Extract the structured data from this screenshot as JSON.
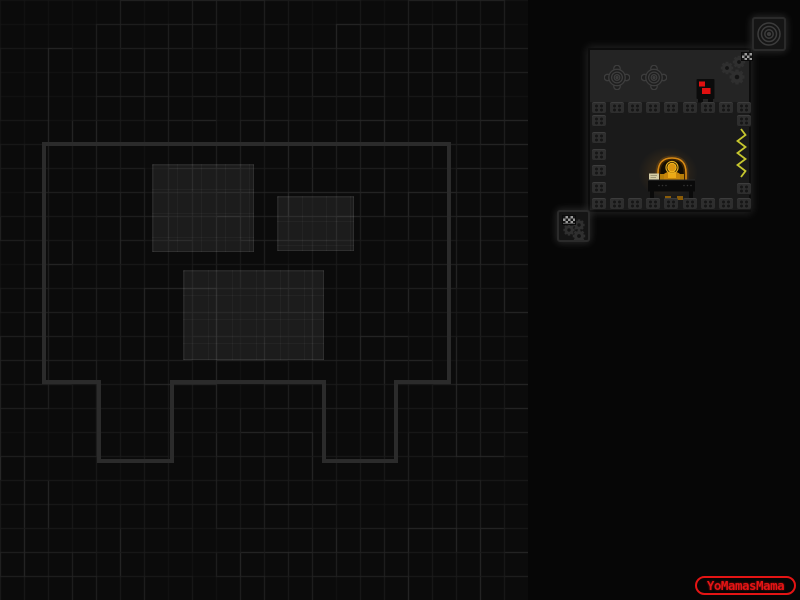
{
  "watermark": {
    "label": "YoMamasMama",
    "color": "#e41414"
  },
  "palette": {
    "screen_bg": "#060606",
    "maze_bg": "#0b0b0b",
    "maze_line_faint": "#141414",
    "maze_line_mid": "#1b1b1b",
    "maze_line_bright": "#2b2b2b",
    "map_outline": "#2b2b2b",
    "panel_top_bg": "#242424",
    "panel_room_bg": "#1a1a1a",
    "panel_border": "#0c0c0c",
    "block": "#2e2e2e",
    "block_dot": "#161616",
    "enemy_body": "#0b0b0b",
    "enemy_red": "#e01010",
    "player_orange": "#c8860a",
    "player_highlight": "#edaa16",
    "halo": "#e8b020",
    "dome_rim": "#d98a14",
    "zigzag": "#c6c62e",
    "paper": "#d6cda6",
    "desk": "#0a0a0a",
    "gear": "#2f2f2f",
    "rosette": "#3d3d3d",
    "tile_bg": "#151515",
    "tile_border": "#2a2a2a",
    "icon_line": "#3c3c3c"
  },
  "map": {
    "region_width": 528,
    "grid_size": 24,
    "outline_points": "44,144 449,144 449,382 396,382 396,461 324,461 324,382 172,382 172,461 99,461 99,382 44,382",
    "rooms": [
      {
        "id": "map-room-left-eye",
        "x": 152,
        "y": 164,
        "w": 100,
        "h": 86
      },
      {
        "id": "map-room-right-eye",
        "x": 277,
        "y": 196,
        "w": 75,
        "h": 53
      },
      {
        "id": "map-room-mouth",
        "x": 183,
        "y": 270,
        "w": 139,
        "h": 88
      }
    ]
  },
  "room_preview": {
    "x": 588,
    "y": 48,
    "w": 163,
    "h": 164,
    "walls": {
      "top_row": {
        "y": 52,
        "count": 9,
        "start_x": 2,
        "pitch": 18.1
      },
      "floor_row": {
        "y": 148,
        "count": 9,
        "start_x": 2,
        "pitch": 18.1
      },
      "left_col": {
        "x": 2,
        "start_y": 65,
        "count": 5,
        "pitch": 16.75
      },
      "right_blocks": [
        {
          "x": 147,
          "y": 65
        },
        {
          "x": 147,
          "y": 133
        }
      ]
    },
    "icons": [
      "rosette-hazard-icon",
      "rosette-hazard-icon",
      "gears-icon",
      "checker-flag-icon"
    ],
    "entities": [
      "red-enemy",
      "player-at-desk",
      "zigzag-spring"
    ]
  },
  "tiles": {
    "spiral_tile": {
      "x": 752,
      "y": 17,
      "w": 34,
      "h": 34,
      "icon": "concentric-circles-icon"
    },
    "gears_tile": {
      "x": 557,
      "y": 210,
      "w": 33,
      "h": 32,
      "icon": "gears-icon"
    }
  }
}
